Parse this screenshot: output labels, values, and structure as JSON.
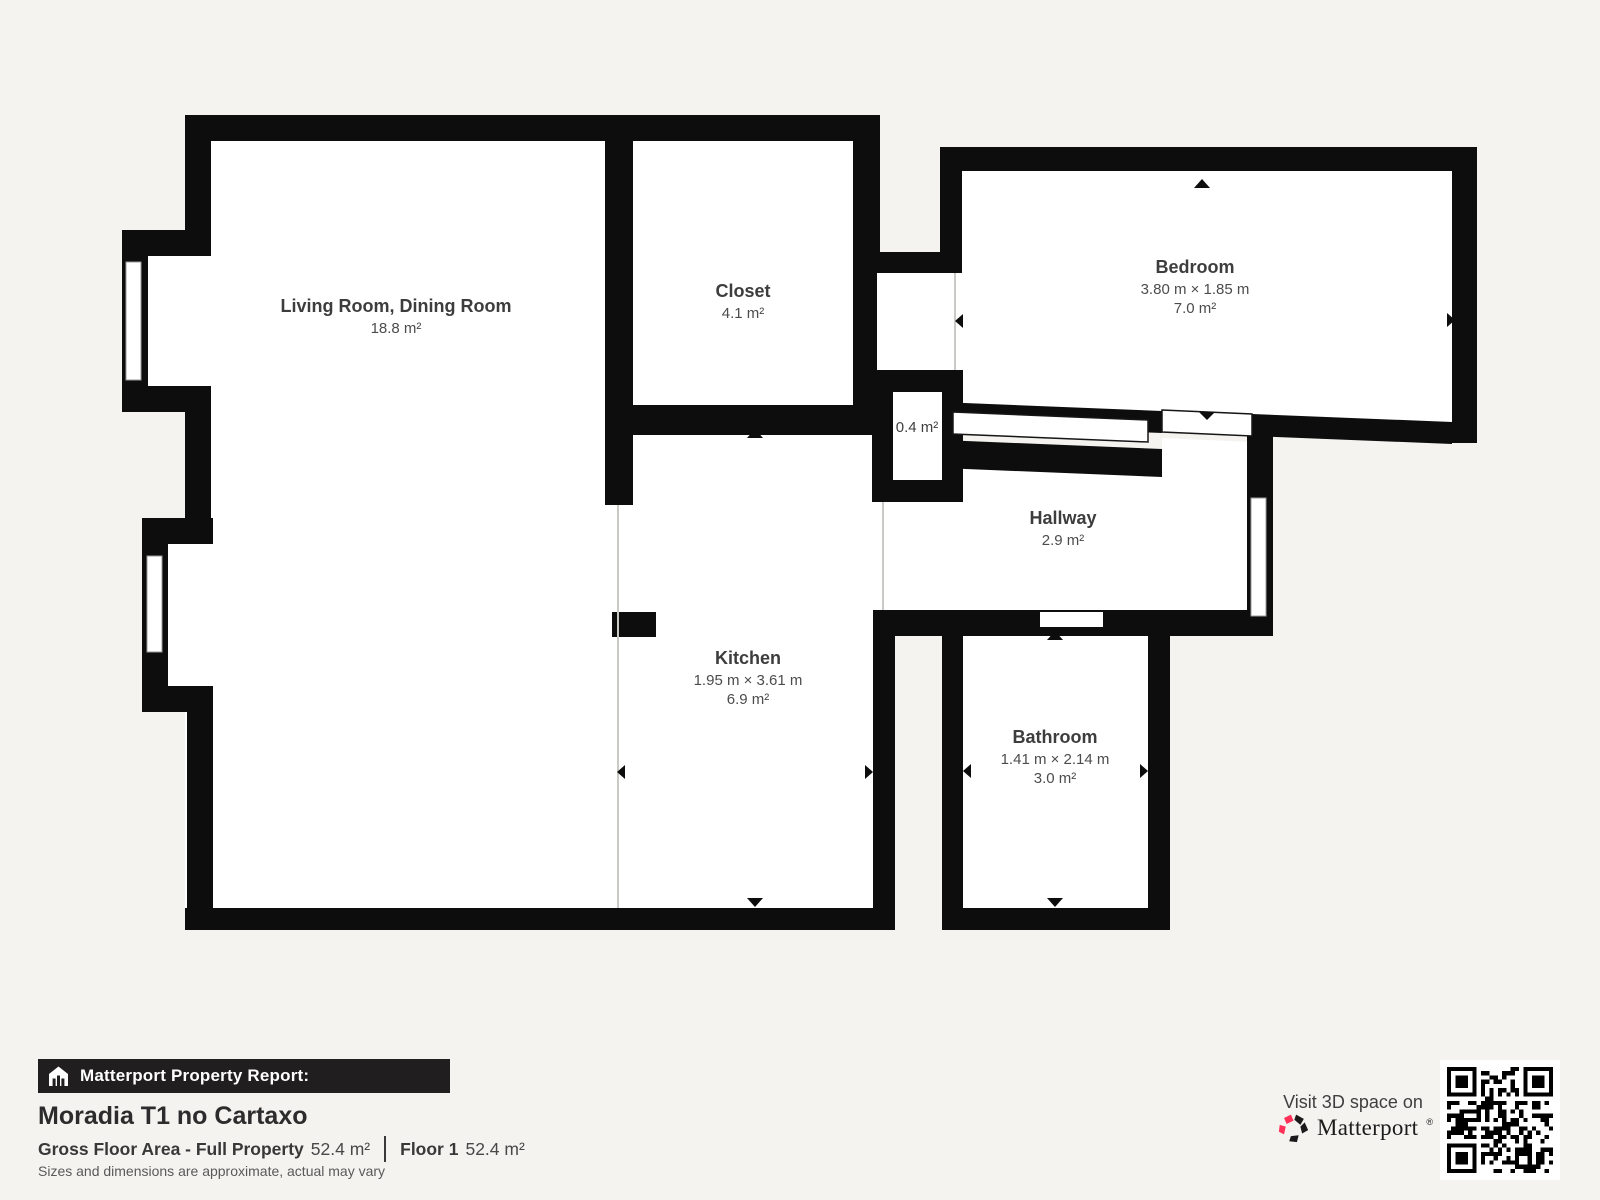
{
  "plan": {
    "rooms": [
      {
        "id": "living",
        "name": "Living Room, Dining Room",
        "area": "18.8 m²"
      },
      {
        "id": "closet",
        "name": "Closet",
        "area": "4.1 m²"
      },
      {
        "id": "bedroom",
        "name": "Bedroom",
        "dims": "3.80 m × 1.85 m",
        "area": "7.0 m²"
      },
      {
        "id": "small-closet",
        "area": "0.4 m²"
      },
      {
        "id": "hallway",
        "name": "Hallway",
        "area": "2.9 m²"
      },
      {
        "id": "kitchen",
        "name": "Kitchen",
        "dims": "1.95 m × 3.61 m",
        "area": "6.9 m²"
      },
      {
        "id": "bathroom",
        "name": "Bathroom",
        "dims": "1.41 m × 2.14 m",
        "area": "3.0 m²"
      }
    ]
  },
  "footer": {
    "report_label": "Matterport Property Report:",
    "property_title": "Moradia T1 no Cartaxo",
    "gross_label": "Gross Floor Area - Full Property",
    "gross_value": "52.4 m²",
    "floor_label": "Floor 1",
    "floor_value": "52.4 m²",
    "disclaimer": "Sizes and dimensions are approximate, actual may vary"
  },
  "promo": {
    "visit_text": "Visit 3D space on",
    "brand": "Matterport",
    "brand_mark": "®"
  },
  "colors": {
    "wall": "#0d0d0d",
    "background": "#f4f3f0",
    "room_fill": "#ffffff",
    "accent_red": "#ff3158",
    "footer_bar": "#201e1e"
  }
}
